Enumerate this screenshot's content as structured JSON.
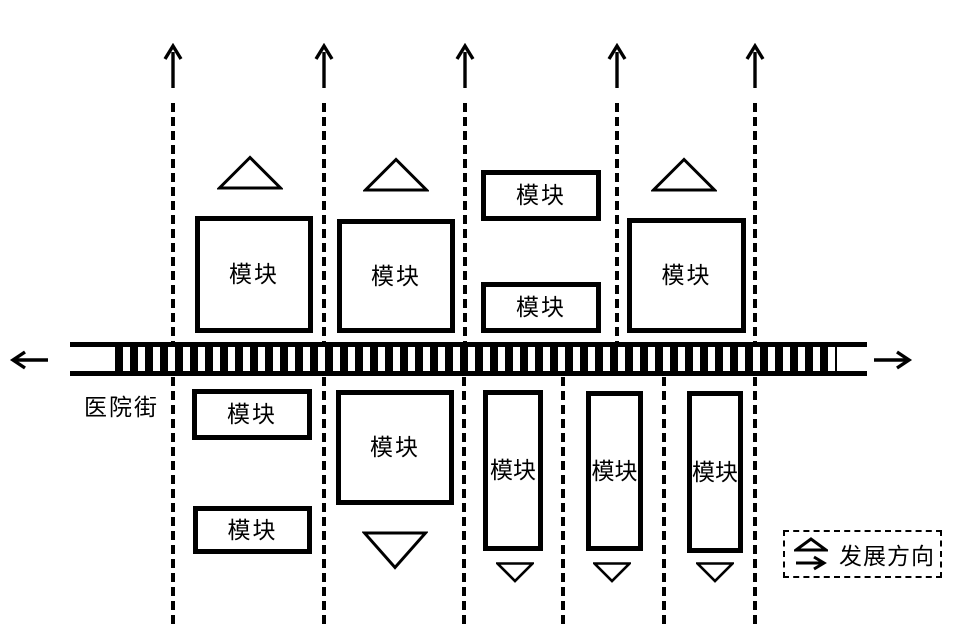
{
  "street": {
    "label": "医院街"
  },
  "modules": [
    {
      "label": "模块"
    },
    {
      "label": "模块"
    },
    {
      "label": "模块"
    },
    {
      "label": "模块"
    },
    {
      "label": "模块"
    },
    {
      "label": "模块"
    },
    {
      "label": "模块"
    },
    {
      "label": "模块"
    },
    {
      "label": "模块"
    },
    {
      "label": "模块"
    },
    {
      "label": "模块"
    }
  ],
  "legend": {
    "label": "发展方向"
  },
  "icons": {
    "up_arrow": "↑",
    "left_arrow": "←",
    "right_arrow": "→",
    "growth_up_triangle": "△",
    "growth_down_triangle": "▽"
  },
  "colors": {
    "line": "#000000",
    "background": "#ffffff"
  }
}
